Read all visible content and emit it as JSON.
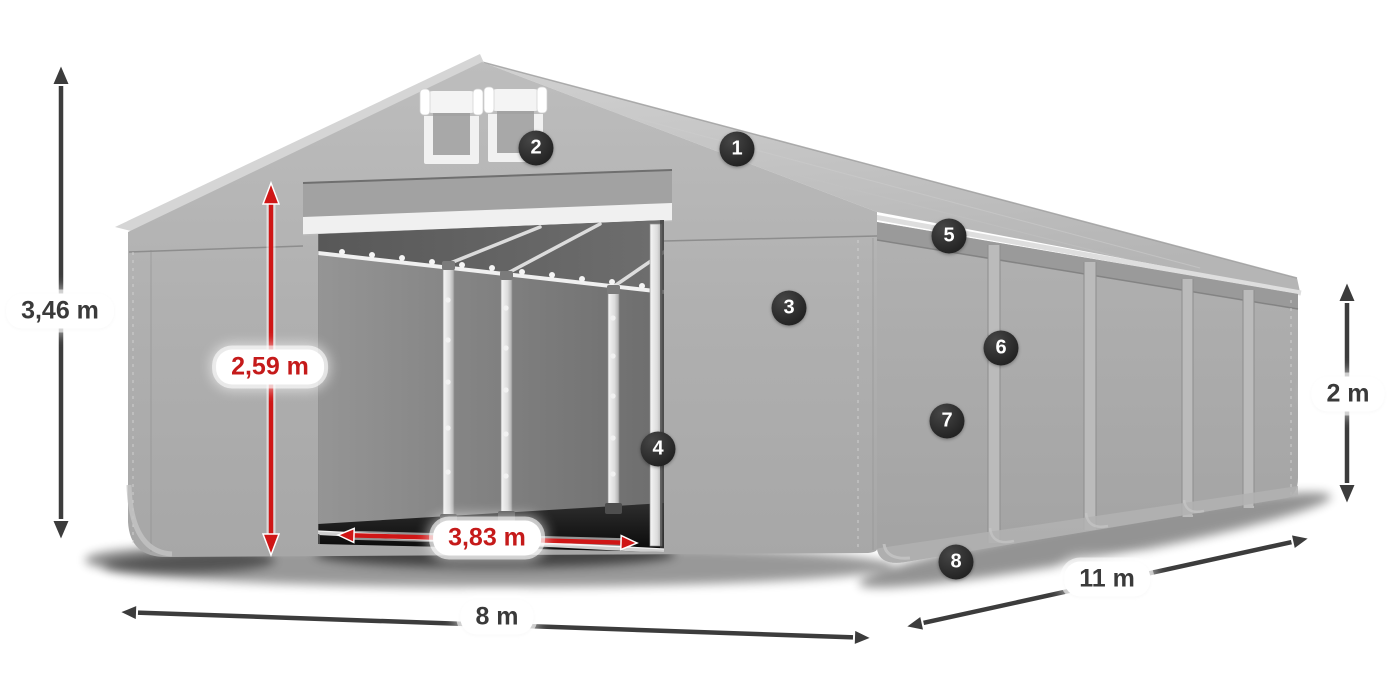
{
  "diagram": {
    "subject": "gray storage tent with open front entrance, dimension arrows and numbered feature callouts",
    "dimensions": [
      {
        "id": "total-height",
        "label": "3,46 m",
        "style": "dark",
        "orientation": "vertical"
      },
      {
        "id": "door-height",
        "label": "2,59 m",
        "style": "red",
        "orientation": "vertical"
      },
      {
        "id": "door-width",
        "label": "3,83 m",
        "style": "red",
        "orientation": "horizontal"
      },
      {
        "id": "front-width",
        "label": "8 m",
        "style": "dark",
        "orientation": "horizontal"
      },
      {
        "id": "side-length",
        "label": "11 m",
        "style": "dark",
        "orientation": "diagonal"
      },
      {
        "id": "side-height",
        "label": "2 m",
        "style": "dark",
        "orientation": "vertical"
      }
    ],
    "callouts": [
      {
        "number": "1"
      },
      {
        "number": "2"
      },
      {
        "number": "3"
      },
      {
        "number": "4"
      },
      {
        "number": "5"
      },
      {
        "number": "6"
      },
      {
        "number": "7"
      },
      {
        "number": "8"
      }
    ],
    "colors": {
      "dimension_dark": "#3c3c3c",
      "dimension_red": "#c51a1a",
      "badge_background": "#2c2c2c",
      "badge_text": "#ffffff",
      "label_background": "#ffffff",
      "tent_roof_gray": "#c6c6c6",
      "tent_wall_gray": "#a9a9a9",
      "tent_interior_gray": "#5f5f5f"
    }
  }
}
